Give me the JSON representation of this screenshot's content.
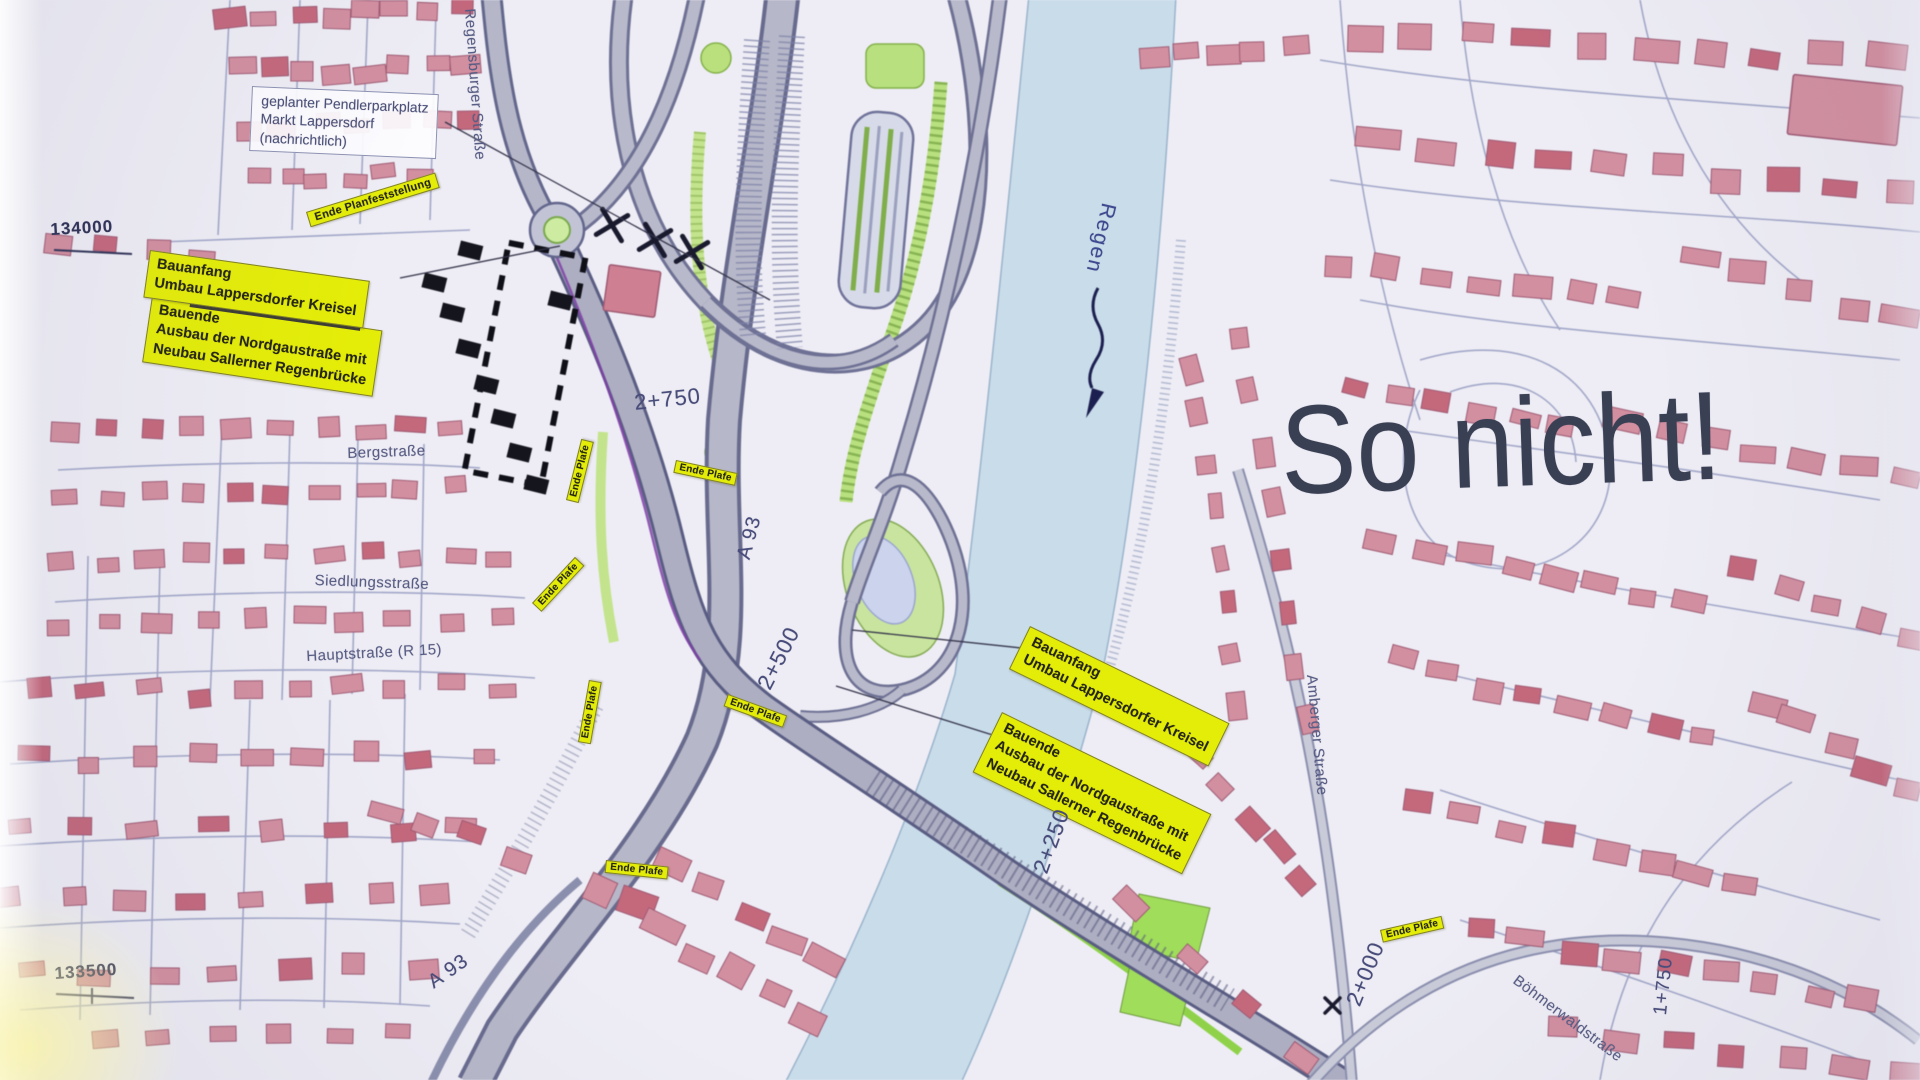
{
  "annotation": {
    "so_nicht": "So nicht!"
  },
  "map": {
    "grid_labels": {
      "north": "134000",
      "south": "133500"
    },
    "river_label": "Regen",
    "highway_labels": {
      "upper": "A 93",
      "lower": "A 93"
    },
    "street_labels": {
      "regensburger": "Regensburger Straße",
      "berg": "Bergstraße",
      "siedlungs": "Siedlungsstraße",
      "haupt": "Hauptstraße (R 15)",
      "amberger": "Amberger Straße",
      "boehmerwald": "Böhmerwaldstraße"
    },
    "chainage_labels": {
      "c2750": "2+750",
      "c2500": "2+500",
      "c2250": "2+250",
      "c2000": "2+000",
      "c1750": "1+750"
    },
    "info_box": {
      "line1": "geplanter Pendlerparkplatz",
      "line2": "Markt Lappersdorf",
      "line3": "(nachrichtlich)"
    },
    "construction_labels": {
      "ende_planfeststellung": "Ende Planfeststellung",
      "ende_plafe": "Ende Plafe",
      "bauanfang_line1": "Bauanfang",
      "bauanfang_line2": "Umbau Lappersdorfer Kreisel",
      "bauende_line1": "Bauende",
      "bauende_line2": "Ausbau der Nordgaustraße mit",
      "bauende_line3": "Neubau Sallerner Regenbrücke"
    },
    "palette": {
      "label_yellow": "#e4ed08",
      "building_pink": "#d28fa0",
      "river_blue": "#c9dcea",
      "green_area": "#c3e48d",
      "annotation_dark": "#3a4053",
      "paper": "#eeedf5"
    }
  }
}
